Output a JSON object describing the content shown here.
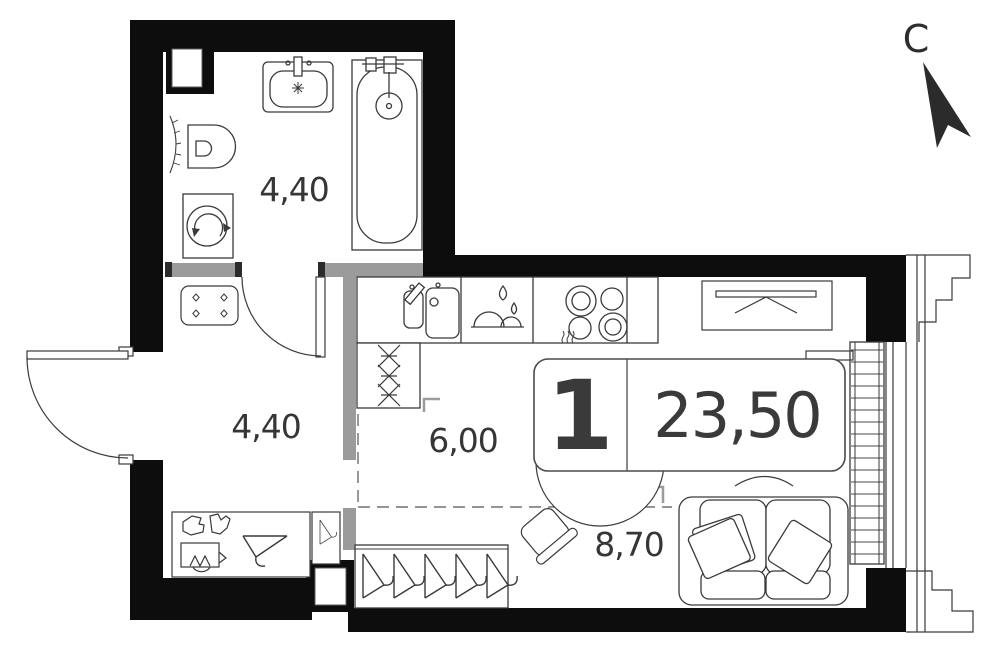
{
  "north_indicator": {
    "label": "С"
  },
  "apartment_badge": {
    "rooms_count": "1",
    "total_area": "23,50"
  },
  "room_areas": {
    "bathroom": "4,40",
    "hallway": "4,40",
    "kitchen": "6,00",
    "living_room": "8,70"
  },
  "colors": {
    "wall": "#0d0d0d",
    "partition": "#9b9b9b",
    "line": "#3a3a3a",
    "text": "#363636",
    "background": "#ffffff"
  },
  "fixtures_present": [
    "bathtub",
    "wash-basin",
    "toilet",
    "washing-machine",
    "towel-rail",
    "vent-shaft",
    "kitchen-sink",
    "dishwasher",
    "stove",
    "tall-cabinet",
    "closet-rod",
    "hanger-wardrobe",
    "entry-hanger",
    "shoe-shelf",
    "dining-table",
    "chair",
    "sofa",
    "radiator",
    "window",
    "entrance-door",
    "bathroom-door",
    "north-arrow"
  ]
}
